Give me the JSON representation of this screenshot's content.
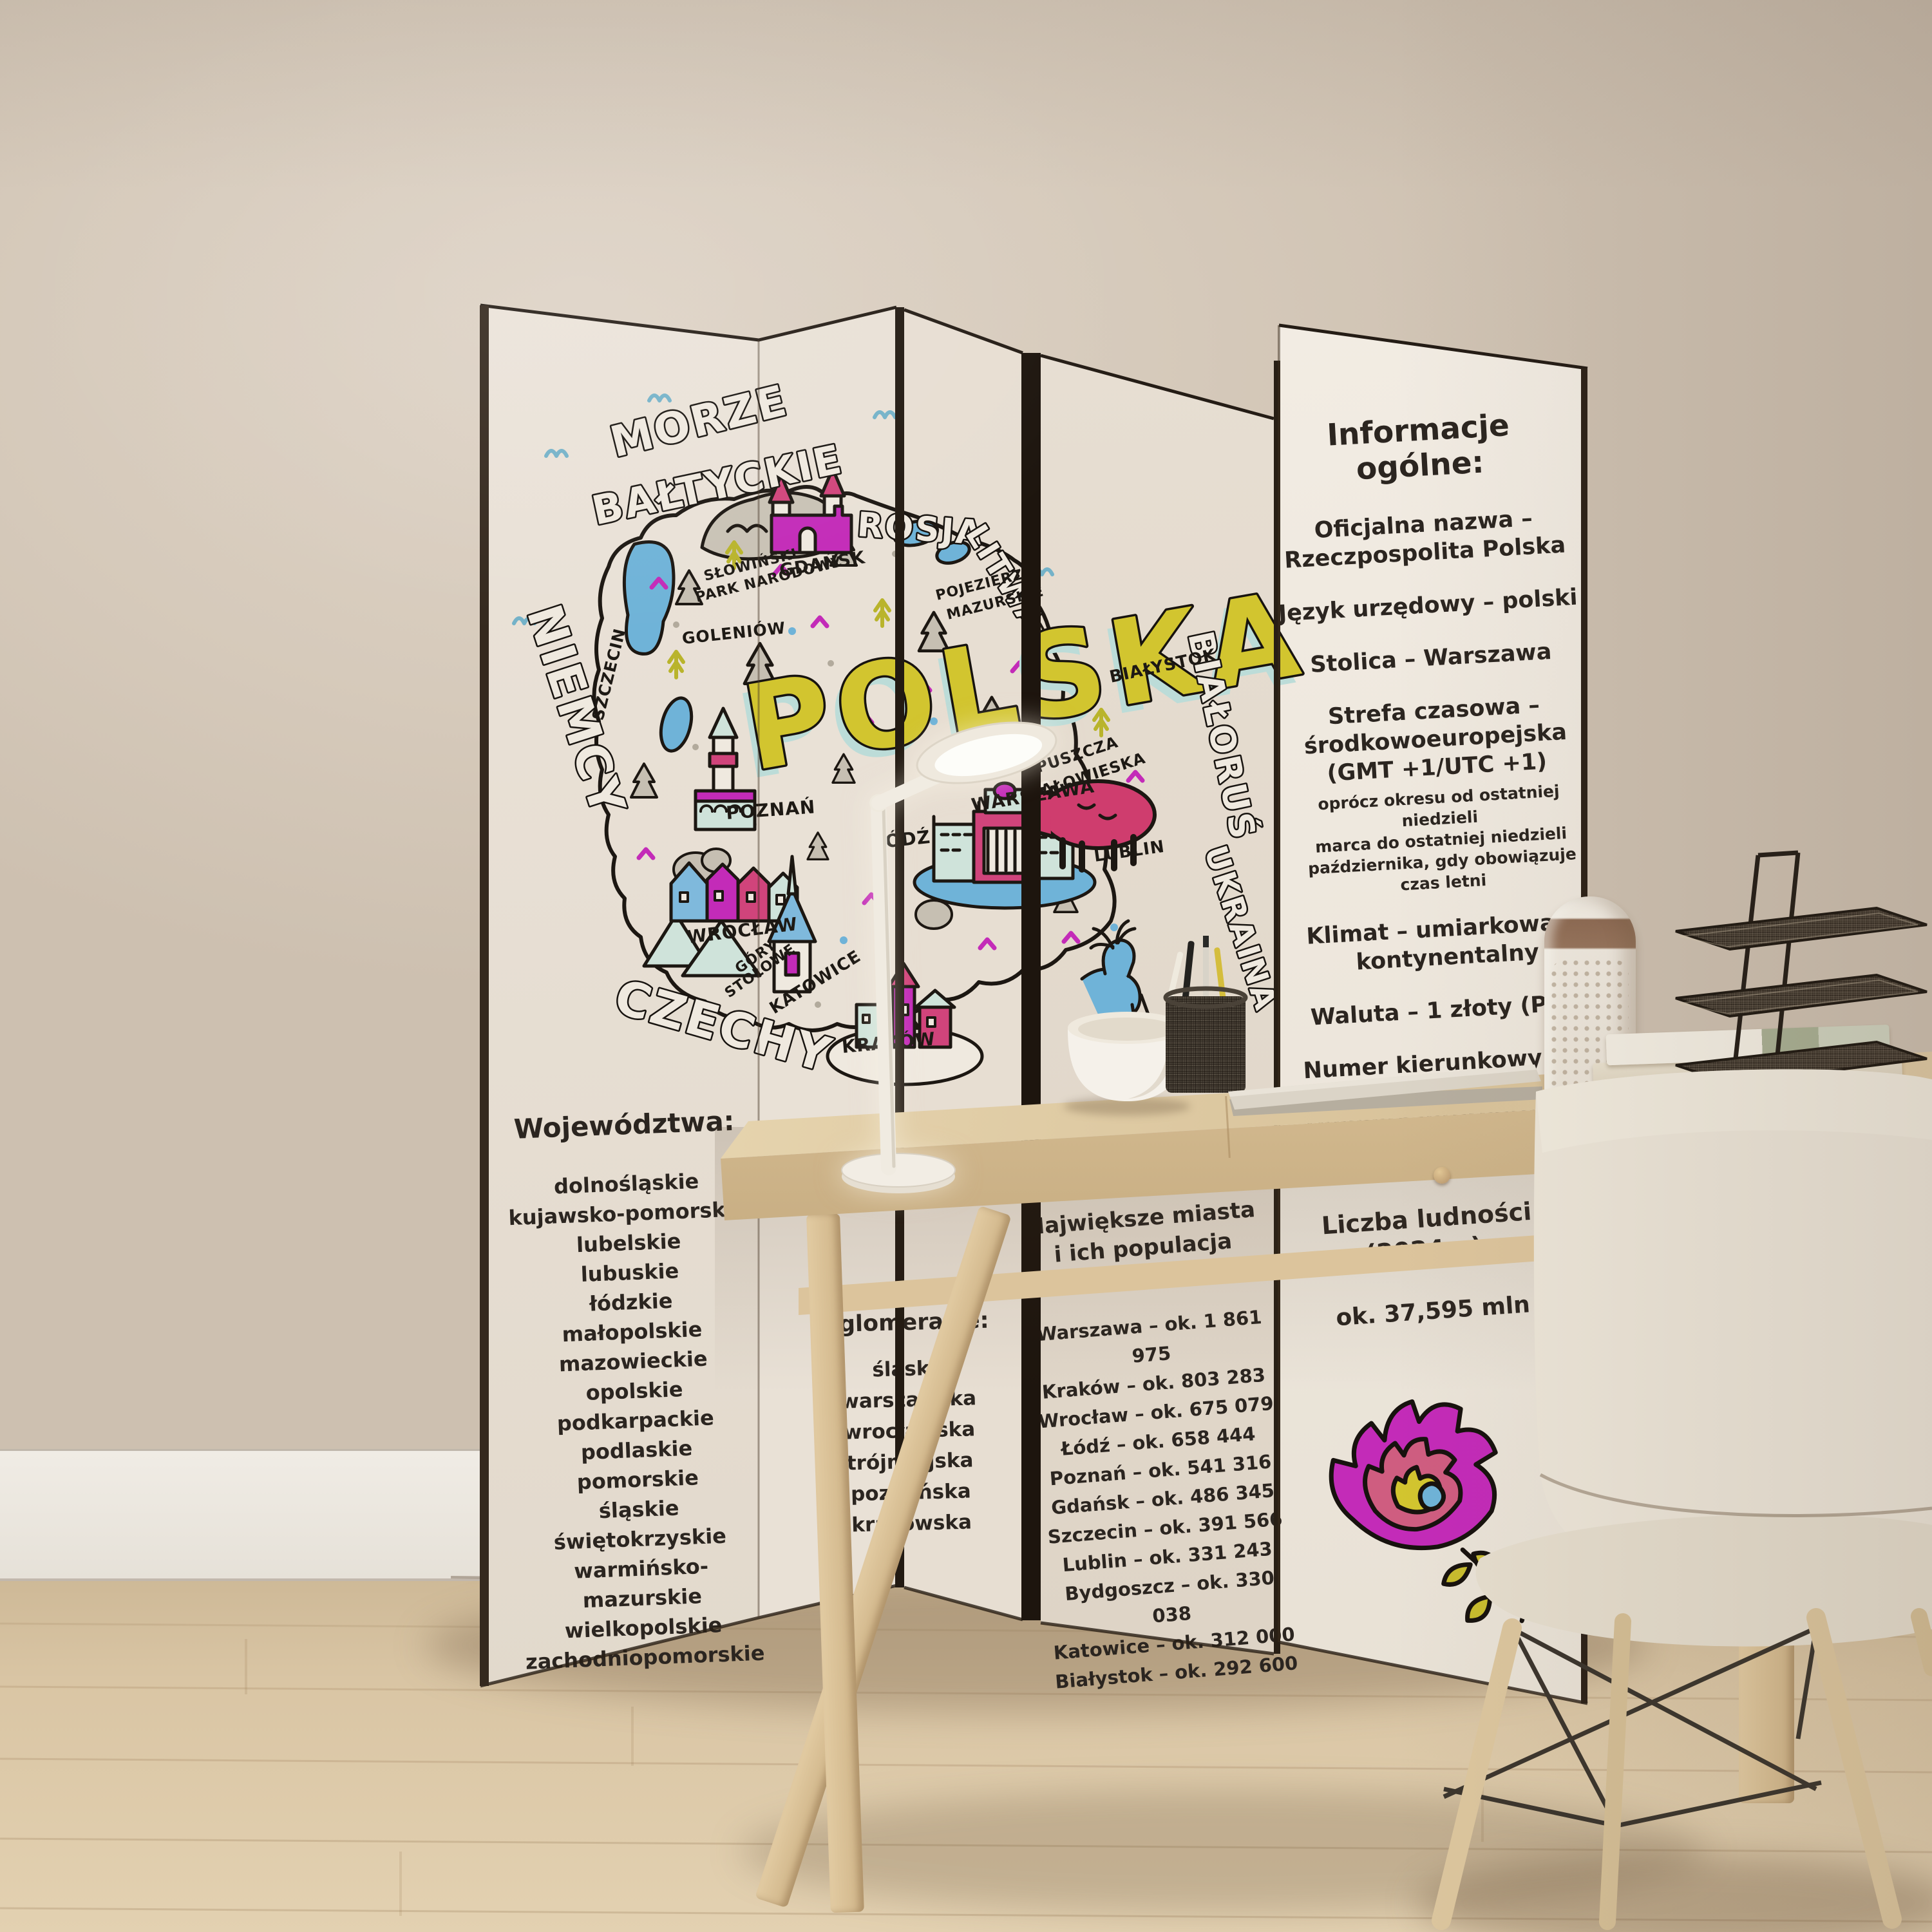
{
  "map": {
    "sea": {
      "line1": "MORZE",
      "line2": "BAŁTYCKIE"
    },
    "country": "POLSKA",
    "neighbors": {
      "west": "NIEMCY",
      "south": "CZECHY",
      "northeast": "ROSJA",
      "north_lithuania": "LITWA",
      "east": "BIAŁORUŚ",
      "southeast": "UKRAINA"
    },
    "places": {
      "szczecin": "SZCZECIN",
      "goleniow": "GOLENIÓW",
      "slowinski": "SŁOWIŃSKI",
      "park_narodowy": "PARK NARODOWY",
      "gdansk": "GDAŃSK",
      "pojezierze": "POJEZIERZE",
      "mazurskie": "MAZURSKIE",
      "bialystok": "BIAŁYSTOK",
      "puszcza": "PUSZCZA",
      "bialowieska": "BIAŁOWIESKA",
      "poznan": "POZNAŃ",
      "warszawa": "WARSZAWA",
      "lodz": "ŁÓDŹ",
      "lublin": "LUBLIN",
      "wroclaw": "WROCŁAW",
      "gory": "GÓRY",
      "stolowe": "STOŁOWE",
      "katowice": "KATOWICE",
      "krakow": "KRAKÓW"
    }
  },
  "voivodeships": {
    "title": "Województwa:",
    "items": [
      "dolnośląskie",
      "kujawsko-pomorskie",
      "lubelskie",
      "lubuskie",
      "łódzkie",
      "małopolskie",
      "mazowieckie",
      "opolskie",
      "podkarpackie",
      "podlaskie",
      "pomorskie",
      "śląskie",
      "świętokrzyskie",
      "warmińsko-mazurskie",
      "wielkopolskie",
      "zachodniopomorskie"
    ]
  },
  "agglomerations": {
    "title": "Największe\naglomeracje:",
    "items": [
      "śląska",
      "warszawska",
      "wrocławska",
      "trójmiejska",
      "poznańska",
      "krakowska"
    ]
  },
  "cities": {
    "title": "Największe miasta\ni ich populacja\n(2024 r.):",
    "items": [
      "Warszawa – ok. 1 861 975",
      "Kraków – ok. 803 283",
      "Wrocław – ok. 675 079",
      "Łódź – ok. 658 444",
      "Poznań – ok. 541 316",
      "Gdańsk – ok. 486 345",
      "Szczecin – ok. 391 566",
      "Lublin – ok. 331 243",
      "Bydgoszcz – ok. 330 038",
      "Katowice – ok. 312 000",
      "Białystok – ok. 292 600"
    ]
  },
  "info": {
    "title": "Informacje ogólne:",
    "official_name": "Oficjalna nazwa –\nRzeczpospolita Polska",
    "language": "Język urzędowy – polski",
    "capital": "Stolica – Warszawa",
    "timezone": "Strefa czasowa –\nśrodkowoeuropejska\n(GMT +1/UTC +1)",
    "timezone_note": "oprócz okresu od ostatniej niedzieli\nmarca do ostatniej niedzieli\npaździernika, gdy obowiązuje\nczas letni",
    "climate": "Klimat – umiarkowany\nkontynentalny",
    "currency": "Waluta – 1 złoty (PLN)",
    "calling_code": "Numer kierunkowy – +4",
    "internet_domain": "Domena internetowa – .",
    "area_partial": "Powierzchnia"
  },
  "population": {
    "title": "Liczba ludności\n(2024 r.):",
    "value": "ok. 37,595 mln"
  },
  "palette": {
    "ink": "#1c1712",
    "paper": "#eae2d7",
    "magenta": "#c32bb8",
    "pink": "#d0447b",
    "yellow": "#d2c52f",
    "blue": "#6fb3d8",
    "mint": "#cfe3da",
    "olive": "#b9b42c",
    "wood": "#dcc49c",
    "wall": "#d6cabb",
    "floor": "#d9c5a4"
  }
}
